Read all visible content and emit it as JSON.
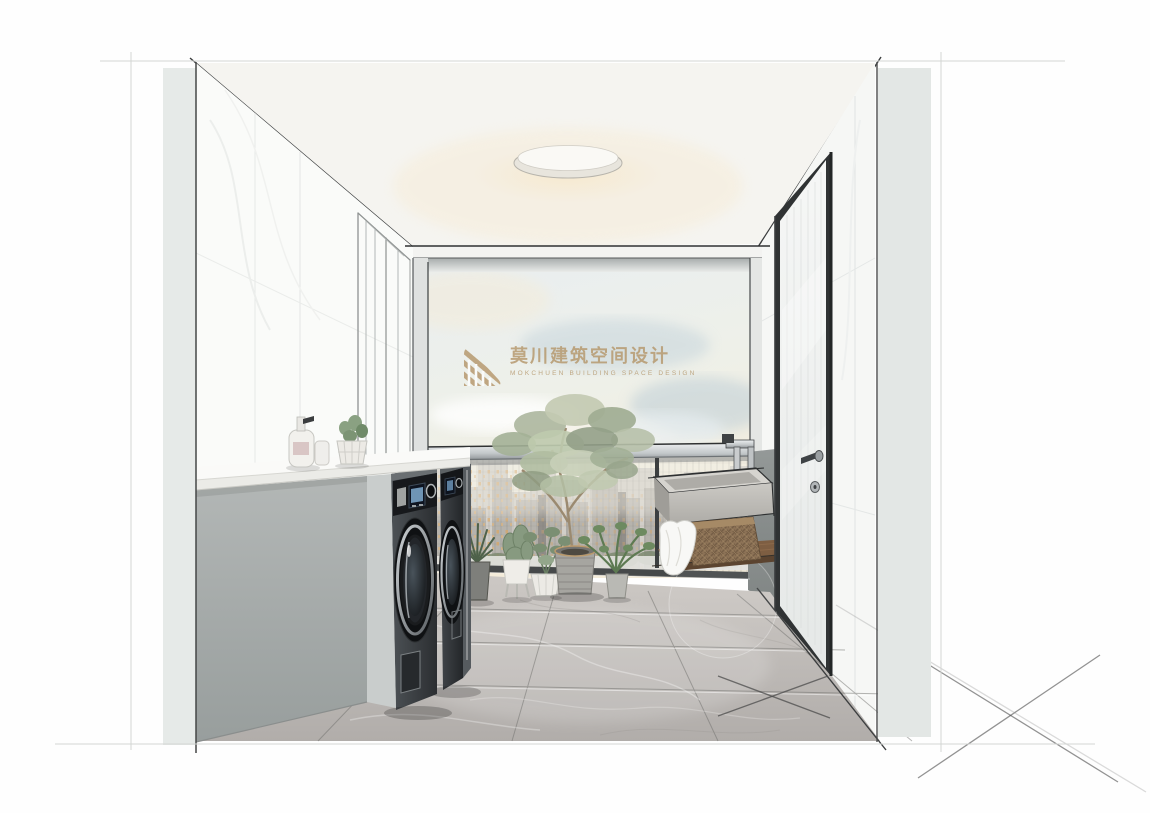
{
  "watermark": {
    "zh": "莫川建筑空间设计",
    "en": "MOKCHUEN BUILDING SPACE DESIGN",
    "color": "#b5976b",
    "icon": "mochuan-stripes-logo"
  },
  "scene": {
    "description": "hand-drawn style interior rendering of a balcony laundry room",
    "objects": [
      "round flush-mount ceiling light",
      "white marble left and right walls with sketch construction lines",
      "floor-to-ceiling window with sky, clouds and city skyline",
      "two dark front-load washing machines",
      "white countertop on gray cabinet",
      "soap dispenser, cup and small potted plant on counter",
      "row of potted plants and tall potted tree by window",
      "concrete laundry sink with chrome faucet on gray wall panel",
      "wood wall shelf with wicker basket and white towel",
      "gray marble tile floor with sketch X marks",
      "white entry door with black frame, lever handle and lock",
      "white paneled door trim on left wall"
    ]
  },
  "palette": {
    "background": "#ffffff",
    "wall": "#f7f8f6",
    "edge_strip": "#e4e8e6",
    "ceiling": "#f5f4f0",
    "floor": "#bfbbb7",
    "cabinet": "#a4a9a8",
    "washer_body": "#34383b",
    "window_frame": "#3a3d3e",
    "sky_warm": "#f3ecda",
    "sky_cool": "#dde7ea",
    "city": "#b7b4af",
    "city_lights": "#d9a766",
    "foliage": "#9fae94",
    "wood_shelf": "#7d5c40",
    "basket": "#8c7256",
    "concrete_sink": "#c6c4bf",
    "watermark_gold": "#b5976b"
  }
}
